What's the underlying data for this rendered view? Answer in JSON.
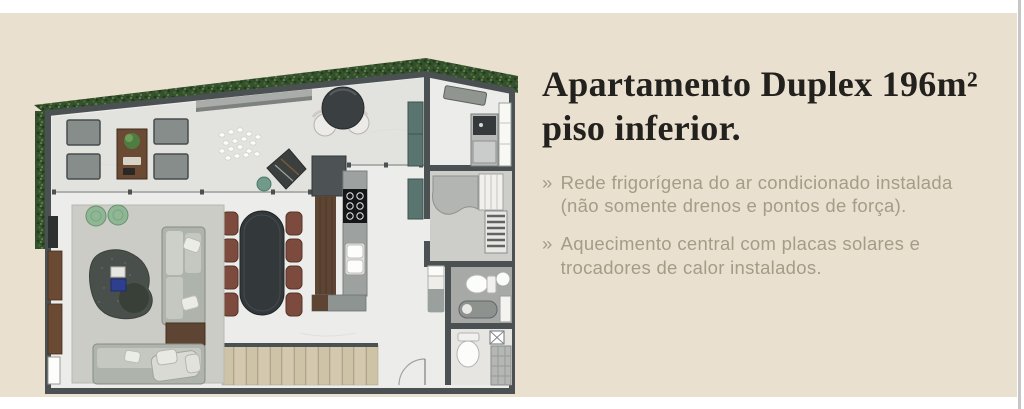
{
  "window": {
    "background": "#ffffff",
    "panel_color": "#e9e0d0",
    "right_edge_line_color": "#c6c6c6"
  },
  "content": {
    "title": "Apartamento Duplex 196m²\npiso inferior.",
    "title_color": "#23211d",
    "bullet_color": "#a49c86",
    "bullets": [
      {
        "marker": "»",
        "text": "Rede frigorígena do ar condicionado instalada\n(não somente drenos e pontos de força)."
      },
      {
        "marker": "»",
        "text": "Aquecimento central com placas solares e\ntrocadores de calor instalados."
      }
    ]
  },
  "floorplan": {
    "label": "planta baixa — piso inferior do apartamento duplex",
    "palette": {
      "wall": "#4b5153",
      "floor": "#ececea",
      "terrace_floor": "#e2e2df",
      "hedge_dark": "#2f4a28",
      "hedge_light": "#5a7d45",
      "rug": "#cbccc6",
      "sofa_gray": "#aeb3ac",
      "wood_brown": "#5d4433",
      "dining_table": "#33383b",
      "chair_brown": "#7d4b3e",
      "pouf_green": "#8fb794",
      "stairs_tan": "#cec2a7",
      "counter_gray": "#9da2a0",
      "teal_cabinet": "#5a7570",
      "fixture_white": "#fcfcfa"
    },
    "elements": [
      "perimeter-hedge",
      "terrace-dining-set",
      "garden-bench",
      "white-stones",
      "outdoor-lounge-chair",
      "bistro-table",
      "glass-sliding-doors",
      "living-rug",
      "l-shaped-sofa",
      "green-poufs",
      "organic-coffee-table",
      "wall-sideboard",
      "oval-dining-table-8-chairs",
      "kitchen-island-cooktop-sink",
      "wood-stairs",
      "service-room-appliance",
      "vanity-room-shelves",
      "upper-bathroom",
      "lower-bathroom",
      "shower-column",
      "daybed"
    ]
  }
}
